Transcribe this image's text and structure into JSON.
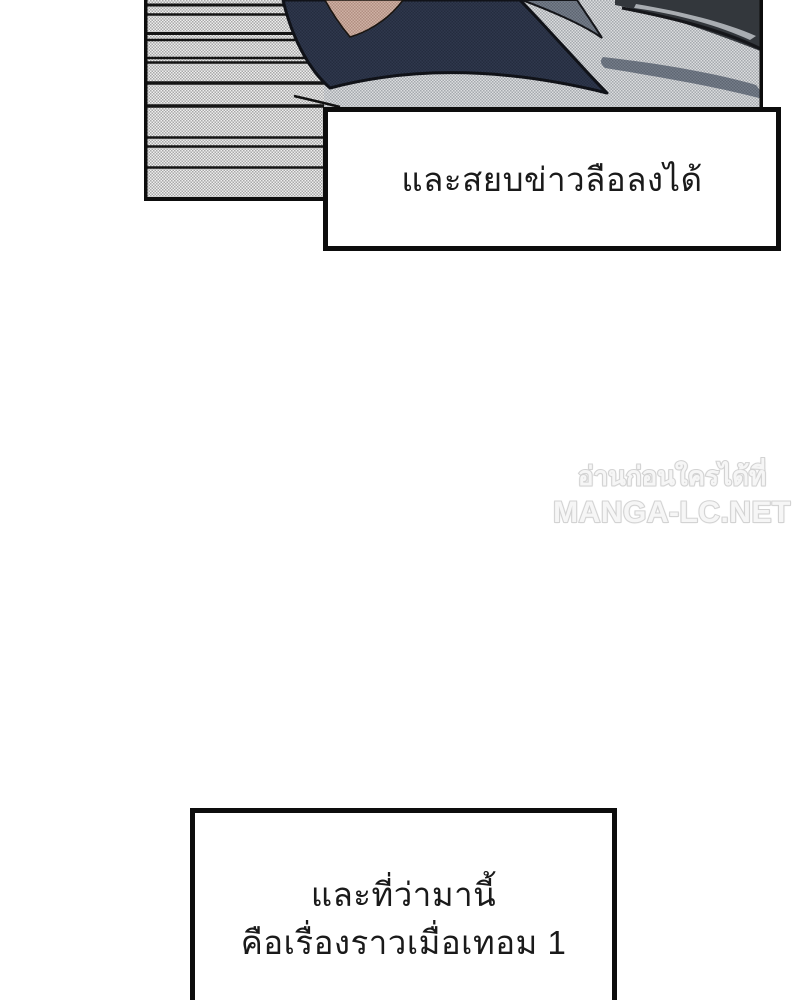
{
  "speech_box_1": {
    "text": "และสยบข่าวลือลงได้"
  },
  "speech_box_2": {
    "line1": "และที่ว่ามานี้",
    "line2": "คือเรื่องราวเมื่อเทอม 1"
  },
  "watermark": {
    "line1": "อ่านก่อนใครได้ที่",
    "line2": "MANGA-LC.NET"
  },
  "colors": {
    "ink": "#0d0d0d",
    "paper": "#ffffff",
    "navy": "#273043",
    "slate": "#6e7582",
    "charcoal": "#33373c",
    "streak": "#a9adb2",
    "skin": "#c8a79a",
    "watermark-fill": "#f6f6f6",
    "watermark-outline": "#d3d3d3",
    "text": "#1a1a1a"
  }
}
